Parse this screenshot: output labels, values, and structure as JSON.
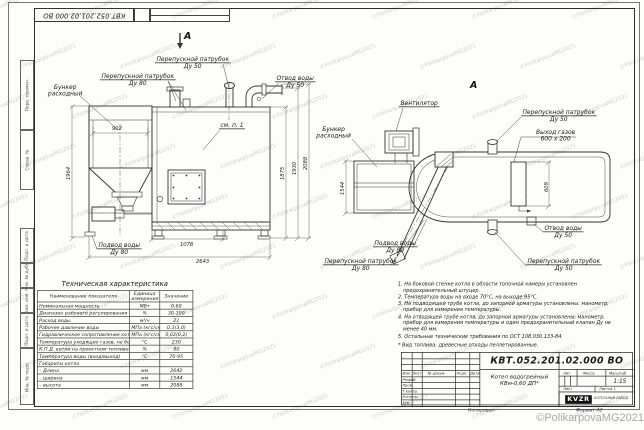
{
  "watermark": {
    "copyright": "©PolikarpovaMG2021"
  },
  "stamp_top": "КВТ.052.201.02.000 ВО",
  "margin_labels": [
    "Перв. примен.",
    "Справ. №",
    "Подп. и дата",
    "Инв. № дубл.",
    "Взам. инв. №",
    "Подп. и дата",
    "Инв. № подл."
  ],
  "front_view": {
    "marker": "А",
    "labels": {
      "bunker": {
        "line1": "Бункер",
        "line2": "расходный"
      },
      "perepusk80_top": {
        "line1": "Перепускной патрубок",
        "line2": "Ду 80"
      },
      "perepusk50_top": {
        "line1": "Перепускной патрубок",
        "line2": "Ду 50"
      },
      "otvod_top": {
        "line1": "Отвод воды",
        "line2": "Ду 50"
      },
      "see_note": "см. п. 1",
      "podvod": {
        "line1": "Подвод воды",
        "line2": "Ду 80"
      }
    },
    "dims": {
      "bunker_width": "902",
      "bunker_height": "1964",
      "h_boiler": "1875",
      "h_mid": "1930",
      "h_total": "2088",
      "conveyor_length": "1078",
      "total_length": "2643"
    }
  },
  "plan_view": {
    "marker": "А",
    "labels": {
      "fan": "Вентилятор",
      "bunker": {
        "line1": "Бункер",
        "line2": "расходный"
      },
      "perepusk50_top": {
        "line1": "Перепускной патрубок",
        "line2": "Ду 50"
      },
      "gas_out": {
        "line1": "Выход газов",
        "line2": "600 x 200"
      },
      "podvod": {
        "line1": "Подвод воды",
        "line2": "Ду 80"
      },
      "perepusk80_bottom": {
        "line1": "Перепускной патрубок",
        "line2": "Ду 80"
      },
      "perepusk50_bottom": {
        "line1": "Перепускной патрубок",
        "line2": "Ду 50"
      },
      "otvod": {
        "line1": "Отвод воды",
        "line2": "Ду 50"
      }
    },
    "dims": {
      "bunker_depth": "1544",
      "gas_out_height": "609"
    }
  },
  "tech_table": {
    "title": "Техническая характеристика",
    "headers": [
      "Наименование показателя",
      "Единица измерения",
      "Значение"
    ],
    "rows": [
      {
        "name": "Номинальная мощность",
        "unit": "МВт",
        "value": "0,60"
      },
      {
        "name": "Диапазон рабочего регулирования",
        "unit": "%",
        "value": "30-100"
      },
      {
        "name": "Расход воды",
        "unit": "м³/ч",
        "value": "21"
      },
      {
        "name": "Рабочее давление воды",
        "unit": "МПа (кгс/см²)",
        "value": "0,3(3,0)"
      },
      {
        "name": "Гидравлическое сопротивление котла",
        "unit": "МПа (кгс/см²)",
        "value": "0,02(0,2)"
      },
      {
        "name": "Температура уходящих газов, не более",
        "unit": "°С",
        "value": "230"
      },
      {
        "name": "К.П.Д. котла на проектном топливе",
        "unit": "%",
        "value": "80"
      },
      {
        "name": "Температура воды (вход/выход)",
        "unit": "°С",
        "value": "70-95"
      },
      {
        "name": "Габариты котла",
        "unit": "",
        "value": ""
      },
      {
        "name": "– Длина",
        "unit": "мм",
        "value": "2642"
      },
      {
        "name": "– ширина",
        "unit": "мм",
        "value": "1544"
      },
      {
        "name": "– высота",
        "unit": "мм",
        "value": "2088"
      }
    ]
  },
  "notes": {
    "items": [
      "1. На боковой стенке котла в области топочной камеры установлен предохранительный штуцер.",
      "2. Температура воды на входе 70°С, на выходе 95°С.",
      "3. На подводящей трубе котла, до запорной арматуры установлены: манометр, прибор для измерения температуры.",
      "4. На отводящей трубе котла, до запорной арматуры установлены: манометр, прибор для измерения температуры и один предохранительный клапан Ду не менее 40 мм.",
      "5. Остальные технические требования по ОСТ 108.030.133-84."
    ],
    "fuel": "* Вид топлива: древесные отходы пеллетированные."
  },
  "title_block": {
    "doc_number": "КВТ.052.201.02.000 ВО",
    "name_line1": "Котел водогрейный",
    "name_line2": "КВм-0,60  ДП*",
    "col_headers": [
      "Изм.",
      "Лист",
      "№ докум.",
      "Подп.",
      "Дата"
    ],
    "sig_rows": [
      "Разраб.",
      "Пров.",
      "Т.контр.",
      "Н.контр.",
      "Утв."
    ],
    "lit_label": "Лит.",
    "mass_label": "Масса",
    "scale_label": "Масштаб",
    "scale_value": "1:15",
    "sheet_label": "Лист",
    "sheets_label": "Листов 1",
    "logo": "KVZR",
    "logo_sub": "КОТЕЛЬНЫЙ ЗАВОД",
    "kopiroval": "Копировал",
    "format": "Формат А2"
  }
}
